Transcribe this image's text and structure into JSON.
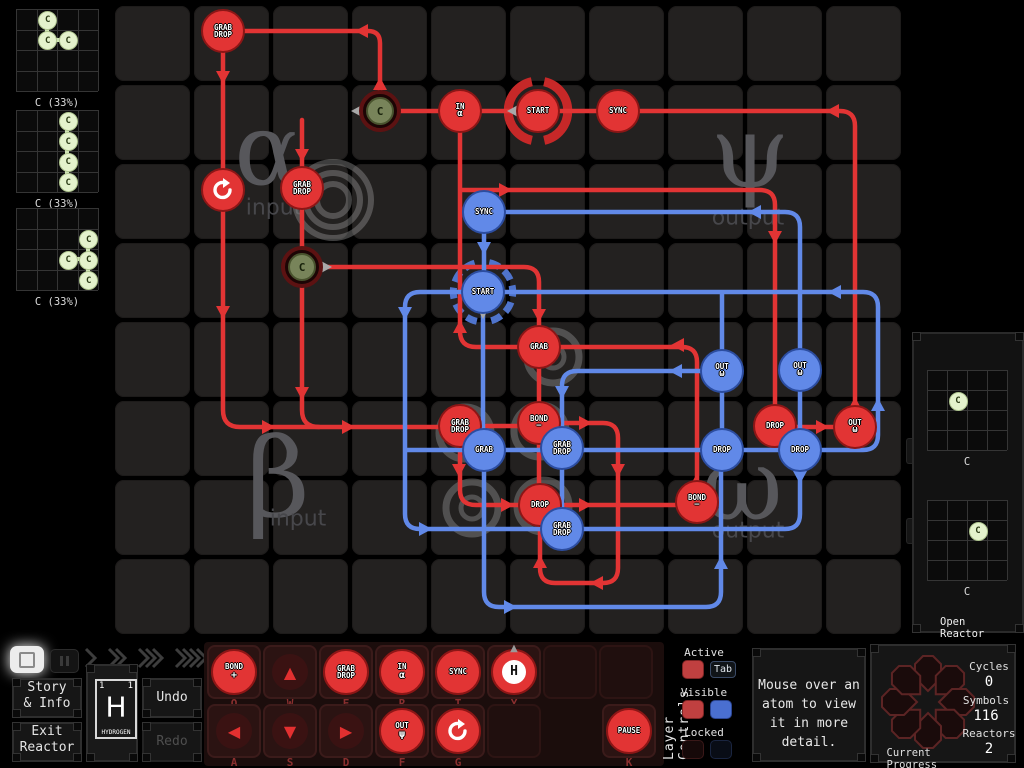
{
  "colors": {
    "red": "#e23434",
    "blue": "#6189e8",
    "grey": "#a9a9a9",
    "ring_red": "#c62828",
    "ring_blue": "#4f74cc",
    "watermark": "#57575b",
    "atom_green": "#e4f2cc"
  },
  "inputs_panel": {
    "grids": [
      {
        "label": "C (33%)",
        "x": 16,
        "y": 9,
        "atoms": [
          {
            "c": 1,
            "r": 0,
            "el": "C"
          },
          {
            "c": 1,
            "r": 1,
            "el": "C"
          },
          {
            "c": 2,
            "r": 1,
            "el": "C"
          }
        ],
        "bonds": [
          [
            1,
            0,
            1,
            1
          ],
          [
            1,
            1,
            2,
            1
          ]
        ]
      },
      {
        "label": "C (33%)",
        "x": 16,
        "y": 110,
        "atoms": [
          {
            "c": 2,
            "r": 0,
            "el": "C"
          },
          {
            "c": 2,
            "r": 1,
            "el": "C"
          },
          {
            "c": 2,
            "r": 2,
            "el": "C"
          },
          {
            "c": 2,
            "r": 3,
            "el": "C"
          }
        ],
        "bonds": [
          [
            2,
            0,
            2,
            1
          ],
          [
            2,
            1,
            2,
            2
          ],
          [
            2,
            2,
            2,
            3
          ]
        ]
      },
      {
        "label": "C (33%)",
        "x": 16,
        "y": 208,
        "atoms": [
          {
            "c": 3,
            "r": 1,
            "el": "C"
          },
          {
            "c": 2,
            "r": 2,
            "el": "C"
          },
          {
            "c": 3,
            "r": 2,
            "el": "C"
          },
          {
            "c": 3,
            "r": 3,
            "el": "C"
          }
        ],
        "bonds": [
          [
            3,
            1,
            3,
            2
          ],
          [
            2,
            2,
            3,
            2
          ],
          [
            3,
            2,
            3,
            3
          ]
        ]
      }
    ]
  },
  "outputs_panel": {
    "open_label": "Open Reactor",
    "grids": [
      {
        "label": "C",
        "x": 927,
        "y": 370,
        "atoms": [
          {
            "c": 1,
            "r": 1,
            "el": "C"
          }
        ],
        "bonds": []
      },
      {
        "label": "C",
        "x": 927,
        "y": 500,
        "atoms": [
          {
            "c": 2,
            "r": 1,
            "el": "C"
          }
        ],
        "bonds": []
      }
    ]
  },
  "reactor": {
    "grid": {
      "x": 113,
      "y": 4,
      "cols": 10,
      "rows": 8,
      "cell": 79
    },
    "watermarks": [
      {
        "text": "α",
        "x": 268,
        "y": 150,
        "size": 100
      },
      {
        "text": "input",
        "x": 274,
        "y": 208,
        "size": 22,
        "small": true
      },
      {
        "text": "ψ",
        "x": 750,
        "y": 152,
        "size": 100
      },
      {
        "text": "output",
        "x": 748,
        "y": 218,
        "size": 22,
        "small": true
      },
      {
        "text": "β",
        "x": 278,
        "y": 478,
        "size": 110
      },
      {
        "text": "input",
        "x": 298,
        "y": 519,
        "size": 22,
        "small": true
      },
      {
        "text": "ω",
        "x": 742,
        "y": 485,
        "size": 100
      },
      {
        "text": "output",
        "x": 748,
        "y": 531,
        "size": 22,
        "small": true
      }
    ],
    "spiral": {
      "x": 333,
      "y": 200,
      "radii": [
        38,
        27,
        16
      ]
    },
    "bonders": [
      {
        "x": 553,
        "y": 357,
        "sign": "+"
      },
      {
        "x": 465,
        "y": 433,
        "sign": ""
      },
      {
        "x": 540,
        "y": 431,
        "sign": ""
      },
      {
        "x": 472,
        "y": 508,
        "sign": ""
      },
      {
        "x": 543,
        "y": 506,
        "sign": "−"
      }
    ],
    "rings": [
      {
        "color": "#c62828",
        "w": 9,
        "dash": "",
        "d": [
          "M544.2,81.7 A30,30 0 0 1 544.2,140.3",
          "M531.8,140.3 A30,30 0 0 1 531.8,81.7"
        ]
      },
      {
        "color": "#4f74cc",
        "w": 7,
        "dash": "11 6",
        "d": [
          "M489.2,262.7 A30,30 0 0 1 489.2,321.3",
          "M476.8,321.3 A30,30 0 0 1 476.8,262.7"
        ]
      }
    ],
    "paths": {
      "red": [
        "M380,92 L380,43 Q380,31 368,31 L240,31",
        "M223,50 L223,410 Q223,427 240,427 L443,427",
        "M302,120 L302,410 Q302,427 319,427",
        "M855,405 L855,126 Q855,111 840,111 L362,111",
        "M697,484 L697,362 Q697,347 682,347 L476,347 Q460,347 460,331 L460,130",
        "M320,267 L524,267 Q539,267 539,282 L539,329",
        "M539,365 L539,487",
        "M462,190 L760,190 Q775,190 775,205 L775,408",
        "M478,426 L521,426",
        "M460,444 L460,490 Q460,505 476,505 L680,505",
        "M557,423 L603,423 Q618,423 618,438 L618,568 Q618,583 603,583 L555,583 Q540,583 540,568 L540,524",
        "M793,427 L836,427"
      ],
      "blue": [
        "M800,468 L800,514 Q800,529 785,529 L420,529 Q405,529 405,514 L405,307 Q405,292 420,292 L863,292 Q878,292 878,307 L878,435 Q878,450 863,450 L405,450",
        "M502,212 L785,212 Q800,212 800,227 L800,351",
        "M800,389 L800,431",
        "M484,231 L484,272",
        "M483,312 L483,431",
        "M722,294 L722,352",
        "M722,390 L722,431",
        "M484,469 L484,592 Q484,607 499,607 L706,607 Q721,607 721,592 L721,469",
        "M703,371 L577,371 Q562,371 562,386 L562,429",
        "M562,467 L562,510"
      ]
    },
    "arrows": [
      {
        "x": 380,
        "y": 84,
        "dir": "up",
        "c": "red"
      },
      {
        "x": 362,
        "y": 31,
        "dir": "left",
        "c": "red"
      },
      {
        "x": 223,
        "y": 77,
        "dir": "down",
        "c": "red"
      },
      {
        "x": 223,
        "y": 312,
        "dir": "down",
        "c": "red"
      },
      {
        "x": 268,
        "y": 427,
        "dir": "right",
        "c": "red"
      },
      {
        "x": 348,
        "y": 427,
        "dir": "right",
        "c": "red"
      },
      {
        "x": 302,
        "y": 155,
        "dir": "down",
        "c": "red"
      },
      {
        "x": 302,
        "y": 393,
        "dir": "down",
        "c": "red"
      },
      {
        "x": 505,
        "y": 190,
        "dir": "right",
        "c": "red"
      },
      {
        "x": 775,
        "y": 237,
        "dir": "down",
        "c": "red"
      },
      {
        "x": 833,
        "y": 111,
        "dir": "left",
        "c": "red"
      },
      {
        "x": 855,
        "y": 404,
        "dir": "up",
        "c": "red"
      },
      {
        "x": 460,
        "y": 327,
        "dir": "up",
        "c": "red"
      },
      {
        "x": 539,
        "y": 315,
        "dir": "down",
        "c": "red"
      },
      {
        "x": 678,
        "y": 345,
        "dir": "left",
        "c": "red"
      },
      {
        "x": 696,
        "y": 482,
        "dir": "up",
        "c": "red"
      },
      {
        "x": 459,
        "y": 470,
        "dir": "down",
        "c": "red"
      },
      {
        "x": 507,
        "y": 505,
        "dir": "right",
        "c": "red"
      },
      {
        "x": 585,
        "y": 505,
        "dir": "right",
        "c": "red"
      },
      {
        "x": 585,
        "y": 423,
        "dir": "right",
        "c": "red"
      },
      {
        "x": 618,
        "y": 470,
        "dir": "down",
        "c": "red"
      },
      {
        "x": 597,
        "y": 583,
        "dir": "left",
        "c": "red"
      },
      {
        "x": 540,
        "y": 562,
        "dir": "up",
        "c": "red"
      },
      {
        "x": 822,
        "y": 427,
        "dir": "right",
        "c": "red"
      },
      {
        "x": 484,
        "y": 248,
        "dir": "down",
        "c": "blue"
      },
      {
        "x": 755,
        "y": 212,
        "dir": "left",
        "c": "blue"
      },
      {
        "x": 835,
        "y": 292,
        "dir": "left",
        "c": "blue"
      },
      {
        "x": 878,
        "y": 405,
        "dir": "up",
        "c": "blue"
      },
      {
        "x": 405,
        "y": 313,
        "dir": "down",
        "c": "blue"
      },
      {
        "x": 425,
        "y": 529,
        "dir": "right",
        "c": "blue"
      },
      {
        "x": 800,
        "y": 477,
        "dir": "down",
        "c": "blue"
      },
      {
        "x": 676,
        "y": 371,
        "dir": "left",
        "c": "blue"
      },
      {
        "x": 562,
        "y": 392,
        "dir": "down",
        "c": "blue"
      },
      {
        "x": 581,
        "y": 450,
        "dir": "right",
        "c": "blue"
      },
      {
        "x": 510,
        "y": 607,
        "dir": "right",
        "c": "blue"
      },
      {
        "x": 721,
        "y": 563,
        "dir": "up",
        "c": "blue"
      },
      {
        "x": 513,
        "y": 111,
        "dir": "left",
        "c": "grey"
      },
      {
        "x": 483,
        "y": 313,
        "dir": "down",
        "c": "grey"
      },
      {
        "x": 357,
        "y": 111,
        "dir": "left",
        "c": "grey"
      },
      {
        "x": 326,
        "y": 267,
        "dir": "right",
        "c": "grey"
      }
    ],
    "nodes": [
      {
        "x": 223,
        "y": 31,
        "color": "red",
        "lines": [
          "GRAB",
          "DROP"
        ]
      },
      {
        "x": 223,
        "y": 190,
        "color": "red",
        "lines": [],
        "icon": "rotate-cw"
      },
      {
        "x": 302,
        "y": 188,
        "color": "red",
        "lines": [
          "GRAB",
          "DROP"
        ]
      },
      {
        "x": 460,
        "y": 111,
        "color": "red",
        "lines": [
          "IN",
          "α"
        ]
      },
      {
        "x": 538,
        "y": 111,
        "color": "red",
        "lines": [
          "START"
        ]
      },
      {
        "x": 618,
        "y": 111,
        "color": "red",
        "lines": [
          "SYNC"
        ]
      },
      {
        "x": 539,
        "y": 347,
        "color": "red",
        "lines": [
          "GRAB"
        ]
      },
      {
        "x": 460,
        "y": 426,
        "color": "red",
        "lines": [
          "GRAB",
          "DROP"
        ]
      },
      {
        "x": 539,
        "y": 423,
        "color": "red",
        "lines": [
          "BOND",
          "−"
        ]
      },
      {
        "x": 540,
        "y": 505,
        "color": "red",
        "lines": [
          "DROP"
        ]
      },
      {
        "x": 697,
        "y": 502,
        "color": "red",
        "lines": [
          "BOND",
          "−"
        ]
      },
      {
        "x": 775,
        "y": 426,
        "color": "red",
        "lines": [
          "DROP"
        ]
      },
      {
        "x": 855,
        "y": 427,
        "color": "red",
        "lines": [
          "OUT",
          "ω"
        ]
      },
      {
        "x": 484,
        "y": 212,
        "color": "blue",
        "lines": [
          "SYNC"
        ]
      },
      {
        "x": 483,
        "y": 292,
        "color": "blue",
        "lines": [
          "START"
        ]
      },
      {
        "x": 484,
        "y": 450,
        "color": "blue",
        "lines": [
          "GRAB"
        ]
      },
      {
        "x": 562,
        "y": 448,
        "color": "blue",
        "lines": [
          "GRAB",
          "DROP"
        ]
      },
      {
        "x": 562,
        "y": 529,
        "color": "blue",
        "lines": [
          "GRAB",
          "DROP"
        ]
      },
      {
        "x": 722,
        "y": 371,
        "color": "blue",
        "lines": [
          "OUT",
          "ω"
        ]
      },
      {
        "x": 800,
        "y": 370,
        "color": "blue",
        "lines": [
          "OUT",
          "ω"
        ]
      },
      {
        "x": 722,
        "y": 450,
        "color": "blue",
        "lines": [
          "DROP"
        ]
      },
      {
        "x": 800,
        "y": 450,
        "color": "blue",
        "lines": [
          "DROP"
        ]
      }
    ],
    "atoms": [
      {
        "x": 380,
        "y": 111,
        "el": "C"
      },
      {
        "x": 302,
        "y": 267,
        "el": "C"
      }
    ]
  },
  "left_controls": {
    "story_line1": "Story",
    "story_line2": "& Info",
    "exit_line1": "Exit",
    "exit_line2": "Reactor",
    "undo": "Undo",
    "redo": "Redo",
    "element": {
      "num_left": "1",
      "num_right": "1",
      "symbol": "H",
      "name": "HYDROGEN"
    },
    "speed_chevrons": [
      1,
      2,
      3,
      4
    ]
  },
  "toolbar": {
    "row1": [
      {
        "key": "Q",
        "kind": "node",
        "lines": [
          "BOND",
          "+"
        ]
      },
      {
        "key": "W",
        "kind": "arrow",
        "glyph": "▲"
      },
      {
        "key": "E",
        "kind": "node",
        "lines": [
          "GRAB",
          "DROP"
        ]
      },
      {
        "key": "R",
        "kind": "node",
        "lines": [
          "IN",
          "α"
        ]
      },
      {
        "key": "T",
        "kind": "node",
        "lines": [
          "SYNC"
        ]
      },
      {
        "key": "Y",
        "kind": "hatom",
        "glyph": "H"
      },
      {
        "kind": "empty"
      },
      {
        "kind": "empty"
      }
    ],
    "row2": [
      {
        "key": "A",
        "kind": "arrow",
        "glyph": "◀"
      },
      {
        "key": "S",
        "kind": "arrow",
        "glyph": "▼"
      },
      {
        "key": "D",
        "kind": "arrow",
        "glyph": "▶"
      },
      {
        "key": "F",
        "kind": "node",
        "lines": [
          "OUT",
          "ψ"
        ]
      },
      {
        "key": "G",
        "kind": "rotate"
      },
      {
        "kind": "empty"
      }
    ],
    "pause": {
      "key": "K",
      "lines": [
        "PAUSE"
      ]
    }
  },
  "layer_controls": {
    "title": "Layer Controls",
    "active_label": "Active",
    "visible_label": "Visible",
    "locked_label": "Locked",
    "tab_key": "Tab"
  },
  "tooltip": {
    "lines": [
      "Mouse over an",
      "atom to view",
      "it in more",
      "detail."
    ]
  },
  "progress": {
    "title": "Current Progress",
    "stats": [
      {
        "label": "Cycles",
        "value": "0"
      },
      {
        "label": "Symbols",
        "value": "116"
      },
      {
        "label": "Reactors",
        "value": "2"
      }
    ]
  }
}
